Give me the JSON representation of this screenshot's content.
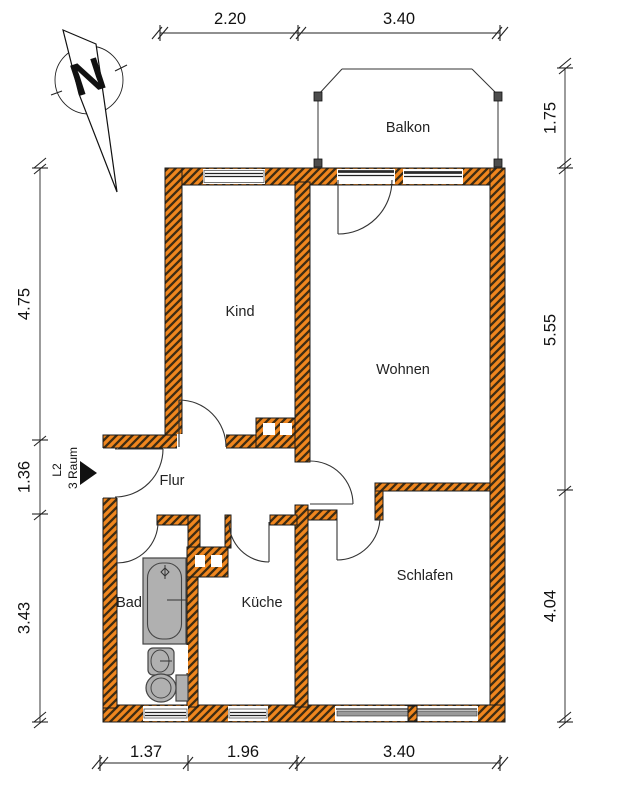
{
  "compass": {
    "north_label": "N"
  },
  "unit_label": {
    "line1": "L2",
    "line2": "3 Raum"
  },
  "rooms": {
    "balkon": "Balkon",
    "kind": "Kind",
    "wohnen": "Wohnen",
    "flur": "Flur",
    "bad": "Bad",
    "kueche": "Küche",
    "schlafen": "Schlafen"
  },
  "dimensions": {
    "top": [
      "2.20",
      "3.40"
    ],
    "bottom": [
      "1.37",
      "1.96",
      "3.40"
    ],
    "left": [
      "4.75",
      "1.36",
      "3.43"
    ],
    "right": [
      "1.75",
      "5.55",
      "4.04"
    ]
  },
  "colors": {
    "wall": "#F0861E",
    "hatch": "#3f2c12",
    "fixture": "#b0b0b0",
    "sill": "#9a9a9a"
  }
}
